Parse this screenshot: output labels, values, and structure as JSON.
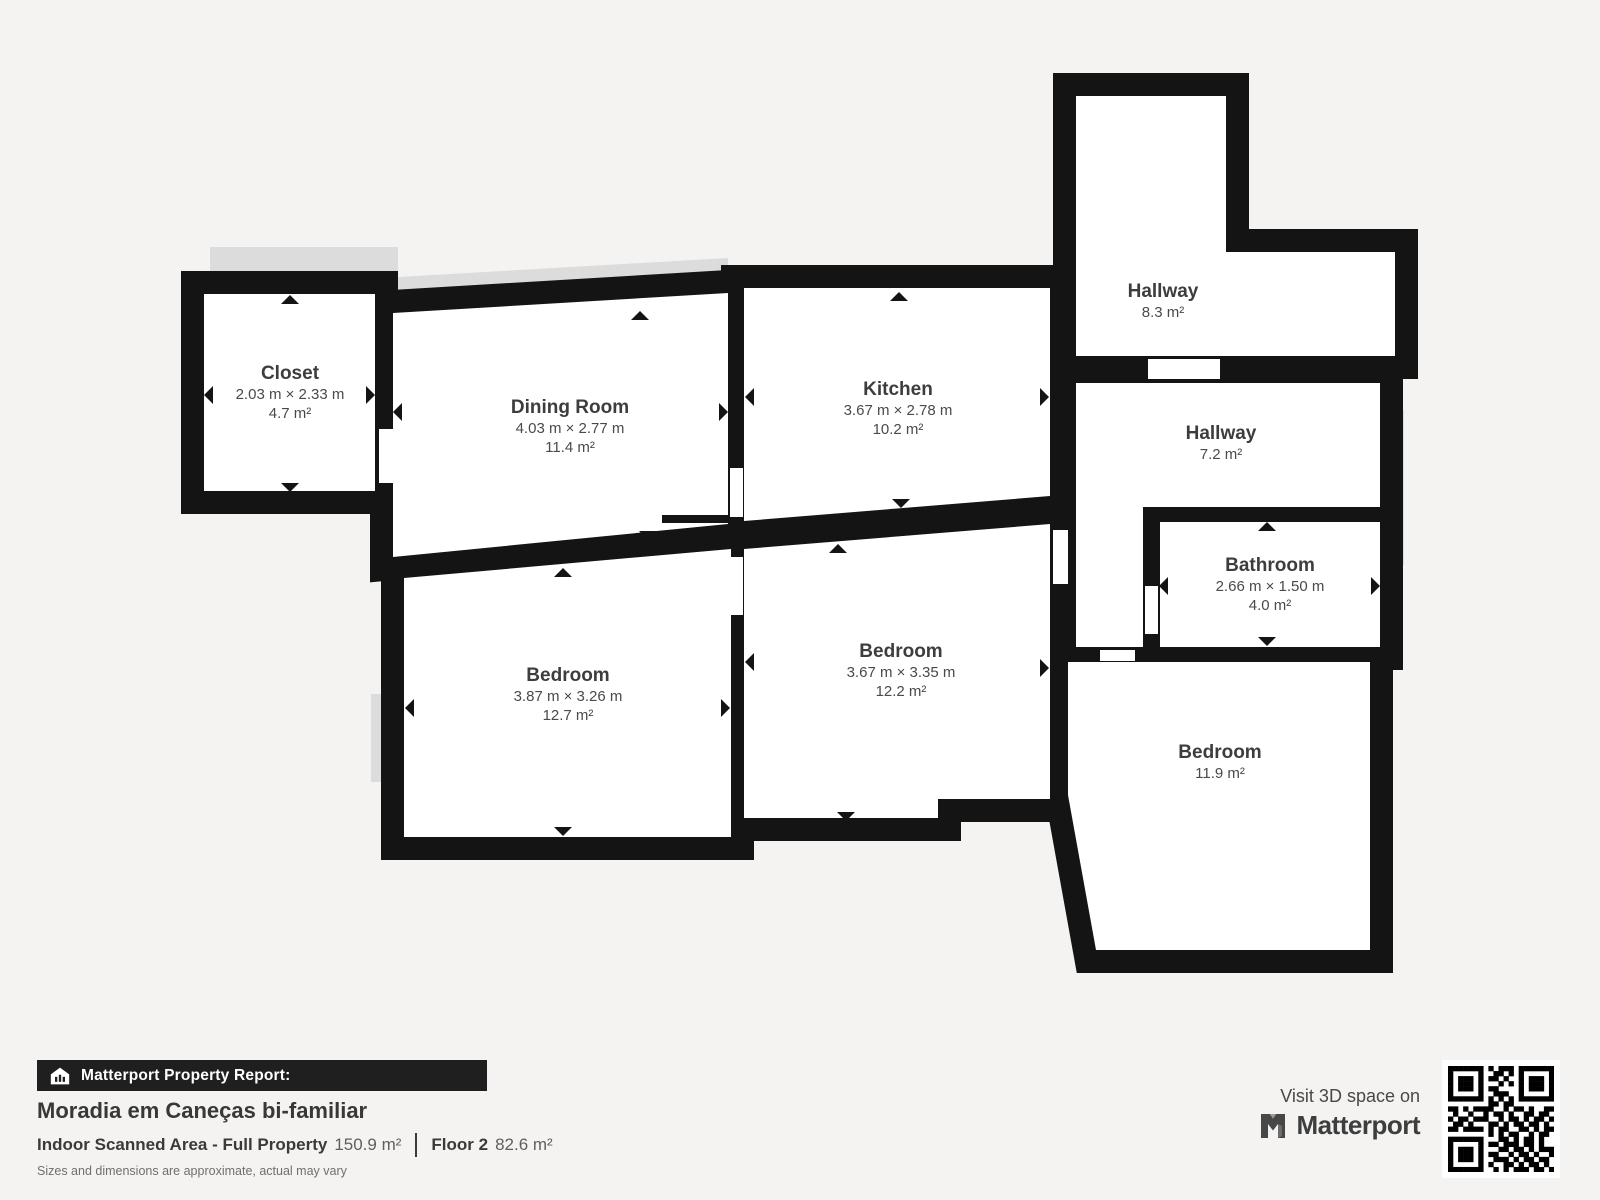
{
  "floorplan": {
    "rooms": [
      {
        "name": "Closet",
        "dims": "2.03 m × 2.33 m",
        "area": "4.7 m²"
      },
      {
        "name": "Dining Room",
        "dims": "4.03 m × 2.77 m",
        "area": "11.4 m²"
      },
      {
        "name": "Kitchen",
        "dims": "3.67 m × 2.78 m",
        "area": "10.2 m²"
      },
      {
        "name": "Hallway",
        "area": "8.3 m²"
      },
      {
        "name": "Hallway",
        "area": "7.2 m²"
      },
      {
        "name": "Bathroom",
        "dims": "2.66 m × 1.50 m",
        "area": "4.0 m²"
      },
      {
        "name": "Bedroom",
        "dims": "3.87 m × 3.26 m",
        "area": "12.7 m²"
      },
      {
        "name": "Bedroom",
        "dims": "3.67 m × 3.35 m",
        "area": "12.2 m²"
      },
      {
        "name": "Bedroom",
        "area": "11.9 m²"
      }
    ]
  },
  "footer": {
    "report_label": "Matterport Property Report:",
    "title": "Moradia em Caneças bi-familiar",
    "scanned_area_label": "Indoor Scanned Area - Full Property",
    "scanned_area_value": "150.9 m²",
    "floor_label": "Floor 2",
    "floor_value": "82.6 m²",
    "disclaimer": "Sizes and dimensions are approximate, actual may vary",
    "visit_label": "Visit 3D space on",
    "brand": "Matterport"
  },
  "colors": {
    "wall": "#141414",
    "room": "#ffffff",
    "background": "#f4f3f1",
    "shadow": "#dcdcdc",
    "bar": "#1f1f1f"
  },
  "icons": [
    "house-icon",
    "matterport-logo-icon",
    "qr-code",
    "measure-arrow-icon"
  ],
  "qr_rows": [
    "111111101011101111111",
    "100000100110101000001",
    "101110101101001011101",
    "101110100010101011101",
    "101110101100001011101",
    "100000100111001000001",
    "111111101010101111111",
    "000000001101100000000",
    "110101111001011010011",
    "010010010110100110110",
    "101101110010110101101",
    "011010001101011011010",
    "110111101011001101011",
    "000000001010110010110",
    "111111100011010110100",
    "100000101101110110100",
    "101110100011011010111",
    "101110101100101101001",
    "101110100111010110110",
    "100000101001101011010",
    "111111100101011101101"
  ]
}
